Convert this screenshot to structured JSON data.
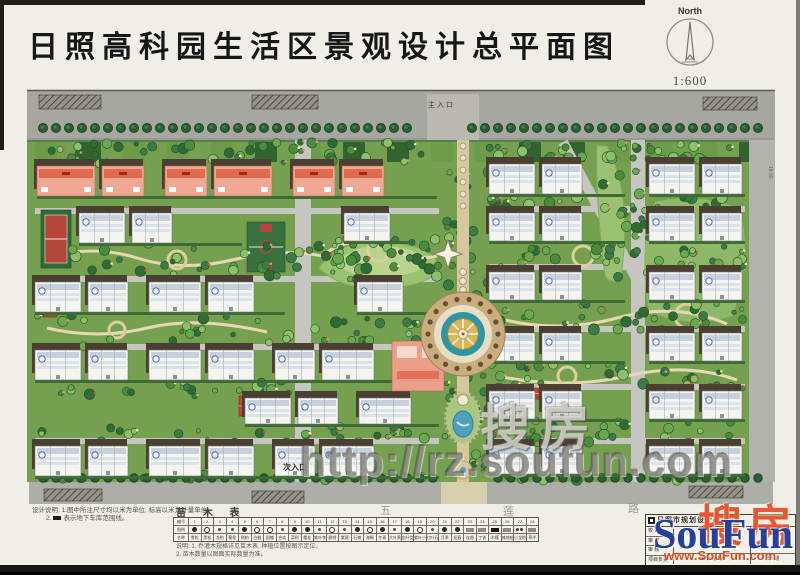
{
  "title": "日照高科园生活区景观设计总平面图",
  "north": {
    "label": "North",
    "scale": "1:600"
  },
  "plan_labels": {
    "main_entrance": "主入口",
    "secondary_entrance": "次入口",
    "road_chars": [
      "五",
      "莲",
      "路"
    ],
    "edge_dim": "18.00"
  },
  "watermark": {
    "cn": "搜房",
    "url": "http://rz.soufun.com"
  },
  "brand": {
    "cn": "搜房",
    "en": "SouFun",
    "site": "www.SouFun.com"
  },
  "notes_left": {
    "line1": "设计说明: 1.图中所注尺寸均以米为单位, 标高以米为计量单位。",
    "line2_prefix": "2.",
    "line2": "表示地下车库范围线。"
  },
  "plant_table": {
    "heading": "苗 木 表",
    "row_labels": [
      "编号",
      "图例",
      "名称"
    ],
    "columns": [
      "1",
      "2",
      "3",
      "4",
      "5",
      "6",
      "7",
      "8",
      "9",
      "10",
      "11",
      "12",
      "13",
      "14",
      "15",
      "16",
      "17",
      "18",
      "19",
      "20",
      "21",
      "22",
      "23",
      "24",
      "25",
      "26",
      "27",
      "28"
    ],
    "symbols": [
      "fc",
      "oc",
      "sc",
      "sc",
      "fc",
      "oc",
      "oc",
      "sc",
      "fc",
      "fc",
      "sc",
      "oc",
      "sc",
      "fc",
      "oc",
      "fc",
      "sc",
      "fc",
      "oc",
      "sc",
      "fc",
      "fc",
      "gr",
      "gr",
      "dk",
      "gr",
      "cc",
      "gr"
    ],
    "names": [
      "雪松",
      "黑松",
      "龙柏",
      "蜀桧",
      "侧柏",
      "白蜡",
      "国槐",
      "合欢",
      "栾树",
      "樱花",
      "紫叶李",
      "碧桃",
      "紫薇",
      "石楠",
      "海桐",
      "冬青",
      "大叶黄杨",
      "金叶女贞",
      "紫叶小檗",
      "红叶石楠",
      "月季",
      "迎春",
      "连翘",
      "丁香",
      "木槿",
      "铺地柏",
      "小龙柏",
      "草坪"
    ]
  },
  "table_notes": {
    "line1": "说明: 1. 乔灌木规格详见苗木表, 种植位置按图示定位。",
    "line2": "2. 苗木数量以图面实际数量为准。"
  },
  "title_block": {
    "institute": "日照市规划设计研究院",
    "rows": [
      "校 对",
      "审 定",
      "审 核",
      "项目负责"
    ],
    "stage_label": "设计阶段",
    "date_label": "日 期"
  },
  "colors": {
    "paper": "#f0efe7",
    "road": "#a7a7a2",
    "road_light": "#c6c6c0",
    "green_base": "#74a050",
    "green_dark": "#3f7336",
    "hedge": "#2e5c30",
    "shadow": "#493f33",
    "building": "#f4f4f1",
    "salmon": "#efa893",
    "red_accent": "#d9604a",
    "court_red": "#b6453a",
    "court_green": "#38703f",
    "water": "#4f9fc0",
    "tan_path": "#d7c79e",
    "plaza_gold": "#d8b75e",
    "plaza_teal": "#2f95a2",
    "soufun_blue": "#24419b",
    "soufun_red": "#e2491d"
  },
  "plan": {
    "rows": [
      {
        "x0": 10,
        "x1": 410,
        "y": 80,
        "h": 30,
        "t": "com"
      },
      {
        "x0": 52,
        "x1": 215,
        "y": 127,
        "h": 30,
        "t": "res"
      },
      {
        "x0": 317,
        "x1": 386,
        "y": 127,
        "h": 28,
        "t": "res"
      },
      {
        "x0": 8,
        "x1": 258,
        "y": 196,
        "h": 30,
        "t": "res"
      },
      {
        "x0": 330,
        "x1": 412,
        "y": 196,
        "h": 30,
        "t": "res"
      },
      {
        "x0": 8,
        "x1": 412,
        "y": 264,
        "h": 30,
        "t": "res"
      },
      {
        "x0": 218,
        "x1": 412,
        "y": 312,
        "h": 26,
        "t": "res"
      },
      {
        "x0": 8,
        "x1": 412,
        "y": 360,
        "h": 30,
        "t": "res"
      },
      {
        "x0": 462,
        "x1": 598,
        "y": 78,
        "h": 30,
        "t": "resacc"
      },
      {
        "x0": 622,
        "x1": 718,
        "y": 78,
        "h": 30,
        "t": "resacc"
      },
      {
        "x0": 462,
        "x1": 598,
        "y": 127,
        "h": 28,
        "t": "res"
      },
      {
        "x0": 622,
        "x1": 718,
        "y": 127,
        "h": 28,
        "t": "res"
      },
      {
        "x0": 462,
        "x1": 598,
        "y": 186,
        "h": 28,
        "t": "res"
      },
      {
        "x0": 622,
        "x1": 718,
        "y": 186,
        "h": 28,
        "t": "res"
      },
      {
        "x0": 462,
        "x1": 598,
        "y": 247,
        "h": 28,
        "t": "res"
      },
      {
        "x0": 622,
        "x1": 718,
        "y": 247,
        "h": 28,
        "t": "res"
      },
      {
        "x0": 462,
        "x1": 598,
        "y": 305,
        "h": 28,
        "t": "res"
      },
      {
        "x0": 622,
        "x1": 718,
        "y": 305,
        "h": 28,
        "t": "res"
      },
      {
        "x0": 462,
        "x1": 598,
        "y": 360,
        "h": 28,
        "t": "res"
      },
      {
        "x0": 622,
        "x1": 718,
        "y": 360,
        "h": 28,
        "t": "res"
      }
    ],
    "h_roads": [
      [
        8,
        122,
        404
      ],
      [
        8,
        190,
        404
      ],
      [
        8,
        258,
        404
      ],
      [
        8,
        352,
        404
      ],
      [
        462,
        120,
        256
      ],
      [
        462,
        178,
        256
      ],
      [
        462,
        240,
        256
      ],
      [
        462,
        298,
        256
      ],
      [
        462,
        352,
        256
      ]
    ],
    "hatch_boxes": [
      [
        12,
        9,
        62,
        14
      ],
      [
        225,
        9,
        66,
        14
      ],
      [
        676,
        11,
        54,
        13
      ],
      [
        17,
        403,
        58,
        12
      ],
      [
        225,
        405,
        52,
        12
      ],
      [
        662,
        400,
        54,
        12
      ]
    ],
    "courts": [
      {
        "x": 14,
        "y": 124,
        "w": 30,
        "h": 58,
        "k": "tennis"
      },
      {
        "x": 220,
        "y": 136,
        "w": 38,
        "h": 50,
        "k": "basket"
      }
    ],
    "pavilions": [
      [
        16,
        222,
        14,
        9
      ],
      [
        212,
        310,
        26,
        20
      ],
      [
        497,
        302,
        15,
        11
      ]
    ],
    "tree_strips": [
      [
        8,
        412,
        56,
        78,
        46
      ],
      [
        8,
        412,
        156,
        194,
        44
      ],
      [
        8,
        412,
        228,
        262,
        40
      ],
      [
        8,
        290,
        294,
        310,
        22
      ],
      [
        8,
        412,
        338,
        358,
        30
      ],
      [
        462,
        716,
        56,
        76,
        30
      ],
      [
        462,
        716,
        110,
        126,
        26
      ],
      [
        462,
        716,
        158,
        184,
        30
      ],
      [
        462,
        716,
        216,
        245,
        32
      ],
      [
        462,
        716,
        277,
        303,
        30
      ],
      [
        462,
        716,
        335,
        358,
        26
      ],
      [
        292,
        412,
        152,
        184,
        26
      ],
      [
        413,
        474,
        56,
        392,
        48
      ],
      [
        576,
        622,
        60,
        196,
        26
      ],
      [
        8,
        412,
        389,
        395,
        10
      ],
      [
        462,
        716,
        389,
        395,
        10
      ]
    ],
    "paths": [
      "M20,172 q45,-14 90,0 t95,2 t90,-4",
      "M20,242 q50,12 100,0 t120,4",
      "M470,232 q60,16 120,0 t110,6",
      "M470,290 q70,14 130,0 t110,4",
      "M300,166 q30,-18 60,-4 t50,8"
    ],
    "loops": [
      [
        150,
        174,
        9
      ],
      [
        556,
        170,
        10
      ],
      [
        352,
        164,
        11
      ],
      [
        660,
        230,
        12
      ],
      [
        90,
        244,
        8
      ],
      [
        540,
        290,
        9
      ]
    ]
  }
}
